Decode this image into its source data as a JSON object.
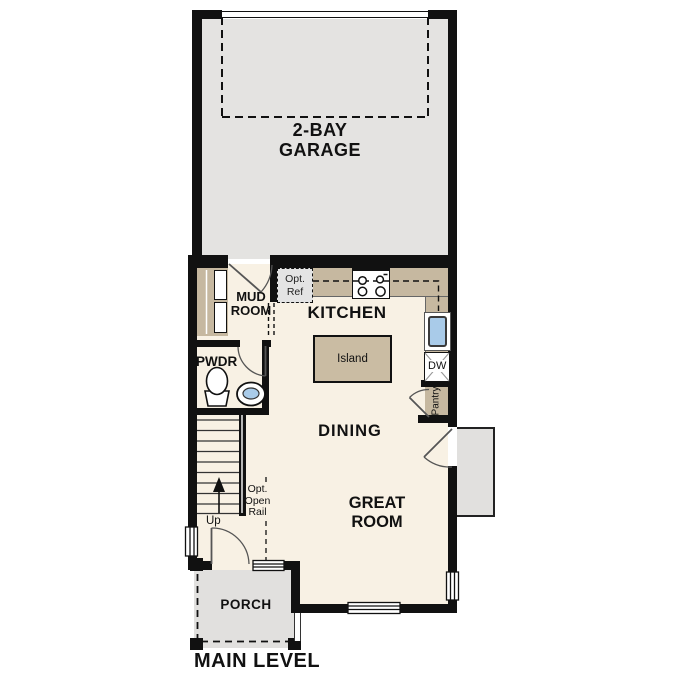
{
  "title": {
    "main_level": "MAIN LEVEL"
  },
  "rooms": {
    "garage": {
      "line1": "2-BAY",
      "line2": "GARAGE"
    },
    "mud": {
      "line1": "MUD",
      "line2": "ROOM"
    },
    "pwdr": {
      "label": "PWDR"
    },
    "kitchen": {
      "label": "KITCHEN"
    },
    "dining": {
      "label": "DINING"
    },
    "great": {
      "line1": "GREAT",
      "line2": "ROOM"
    },
    "porch": {
      "label": "PORCH"
    }
  },
  "fixtures": {
    "island": {
      "label": "Island"
    },
    "opt_ref": {
      "line1": "Opt.",
      "line2": "Ref"
    },
    "dishwasher": {
      "label": "DW"
    },
    "pantry": {
      "label": "Pantry"
    },
    "stairs": {
      "up": "Up",
      "rail_line1": "Opt.",
      "rail_line2": "Open",
      "rail_line3": "Rail"
    }
  },
  "colors": {
    "wall": "#111111",
    "floor": "#f8f1e4",
    "garage_floor": "#e4e3e1",
    "porch_gray": "#e1e0de",
    "counter_tan": "#c6b8a0",
    "island_tan": "#cabca3",
    "opt_ref_gray": "#e4e4e4",
    "sink_blue": "#a9cbe9",
    "door_stroke": "#555555"
  }
}
